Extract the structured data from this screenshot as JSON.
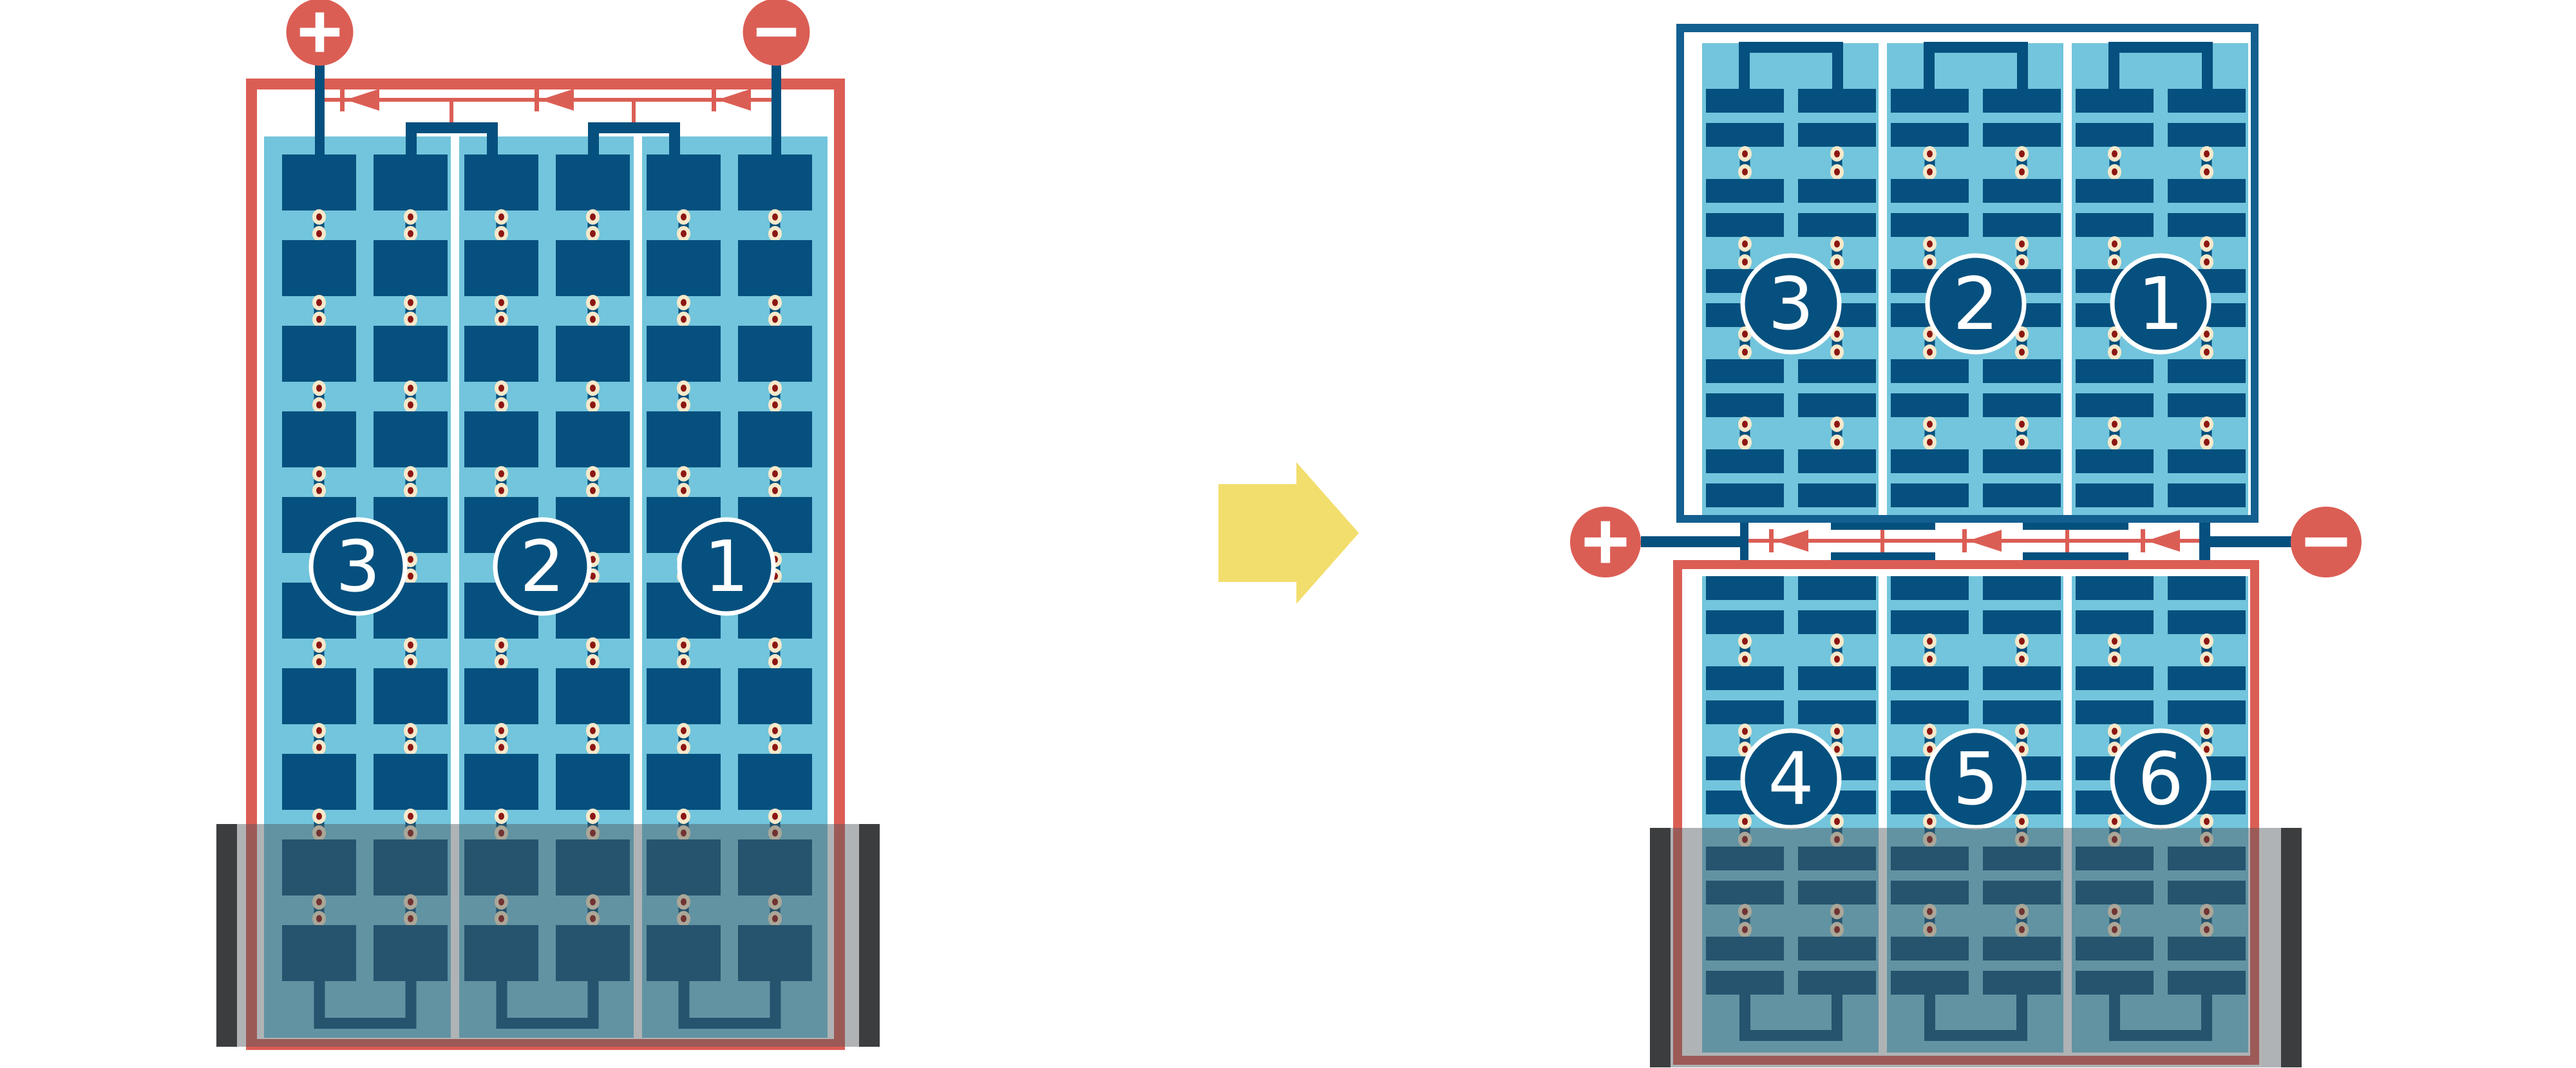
{
  "page": {
    "background": "#FFFFFF"
  },
  "colors": {
    "wire_red": "#DB5E55",
    "frame_blue": "#135F90",
    "cell_blue": "#05507E",
    "panel_blue": "#72C5DC",
    "arrow_yellow": "#F2DE6D",
    "dot_ring": "#F6E9CB",
    "dot_core": "#8C1712",
    "shade_gray": "#50565C",
    "shade_bar": "#3B3D3F",
    "label_white": "#FFFFFF",
    "gap_white": "#FFFFFF"
  },
  "before": {
    "terminals": {
      "positive_label": "+",
      "negative_label": "−"
    },
    "string_labels": [
      "3",
      "2",
      "1"
    ],
    "string_count": 3,
    "cell_rows": 10,
    "bypass_diode_count": 3,
    "shaded_region": "bottom"
  },
  "after": {
    "top_module": {
      "string_labels": [
        "3",
        "2",
        "1"
      ],
      "half_cell_rows": 10
    },
    "bottom_module": {
      "string_labels": [
        "4",
        "5",
        "6"
      ],
      "half_cell_rows": 10
    },
    "terminals": {
      "positive_label": "+",
      "negative_label": "−"
    },
    "bypass_diode_count": 3,
    "shaded_region": "bottom"
  },
  "arrow": {
    "direction": "right"
  }
}
